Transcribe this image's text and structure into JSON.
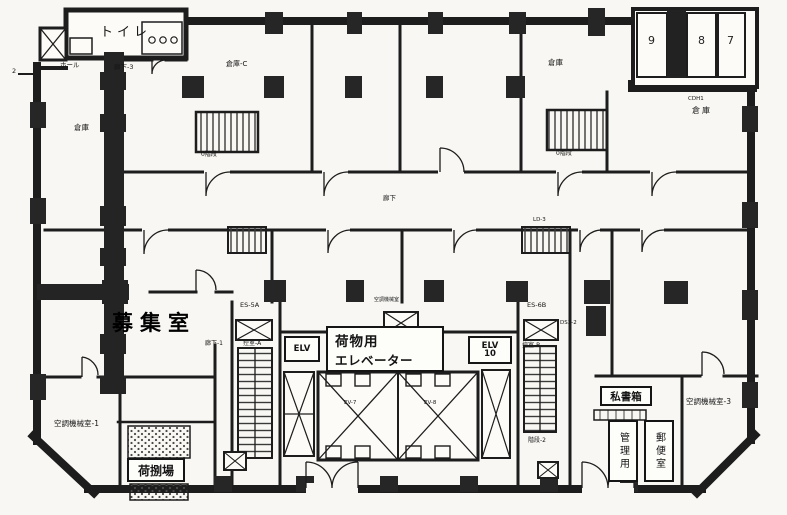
{
  "annotations": {
    "recruit_room": "募集室"
  },
  "rooms": {
    "toilet": "トイレ",
    "hall": "ホール",
    "corridor_3": "廊下-3",
    "corridor_main": "廊下",
    "corridor_1": "廊下-1",
    "storage_west": "倉庫",
    "storage_c": "倉庫-C",
    "storage_mid": "倉庫",
    "storage_ne": "倉庫",
    "anteroom_a": "控室-A",
    "anteroom_b": "控室-B",
    "ac_room_1": "空調機械室-1",
    "ac_room_3": "空調機械室-3",
    "ac_small": "空調機械室",
    "loading_dock": "荷捌場",
    "po_box": "私書箱",
    "admin_room": "管理用",
    "mail_room": "郵便室"
  },
  "units": {
    "u9": "9",
    "u8": "8",
    "u7": "7"
  },
  "elevators": {
    "freight_1": "荷物用",
    "freight_2": "エレベーター",
    "elv": "ELV",
    "elv10_1": "ELV",
    "elv10_2": "10",
    "ev7": "EV-7",
    "ev8": "EV-8"
  },
  "stairs": {
    "s1": "0階段",
    "s2": "0階段",
    "s4": "LD-3",
    "s_b2": "階段-2"
  },
  "codes": {
    "es5a": "ES-5A",
    "es6b": "ES-6B",
    "ds32": "DS3-2",
    "cdh1": "CDH1",
    "tick": "2"
  }
}
